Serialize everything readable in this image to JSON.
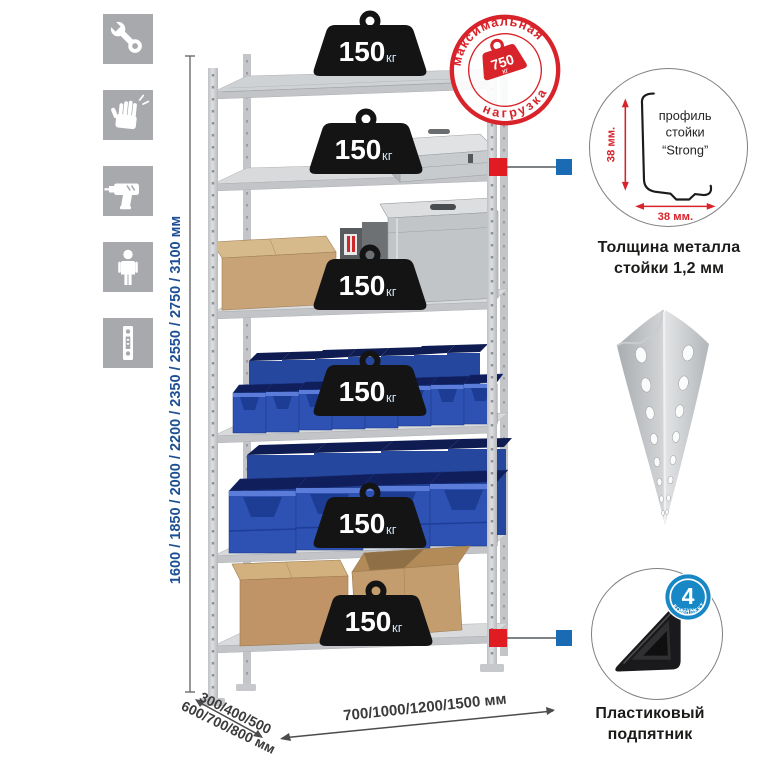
{
  "sidebar_icons": [
    {
      "name": "wrench"
    },
    {
      "name": "gloves"
    },
    {
      "name": "drill"
    },
    {
      "name": "person"
    },
    {
      "name": "rack-post"
    }
  ],
  "dimensions": {
    "height_label": "1600 / 1850 / 2000 / 2200 / 2350 / 2550 / 2750 / 3100 мм",
    "depth_line1": "300/400/500",
    "depth_line2": "600/700/800 мм",
    "width_label": "700/1000/1200/1500 мм"
  },
  "max_load_stamp": {
    "arc_top": "максимальная",
    "arc_bottom": "нагрузка",
    "value": "750",
    "unit": "кг"
  },
  "shelf_loads": [
    {
      "value": "150",
      "unit": "кг"
    },
    {
      "value": "150",
      "unit": "кг"
    },
    {
      "value": "150",
      "unit": "кг"
    },
    {
      "value": "150",
      "unit": "кг"
    },
    {
      "value": "150",
      "unit": "кг"
    },
    {
      "value": "150",
      "unit": "кг"
    }
  ],
  "profile_detail": {
    "label_line1": "профиль",
    "label_line2": "стойки",
    "label_line3": "“Strong”",
    "dim_vertical": "38 мм.",
    "dim_horizontal": "38 мм.",
    "caption_line1": "Толщина металла",
    "caption_line2": "стойки 1,2 мм"
  },
  "kit_badge": {
    "value": "4",
    "small_label": "штуки",
    "arc_label": "В КОМПЛЕКТЕ"
  },
  "foot_detail": {
    "caption_line1": "Пластиковый",
    "caption_line2": "подпятник"
  },
  "colors": {
    "accent_red": "#d8232a",
    "callout_blue": "#1b6bb4",
    "kit_badge_blue": "#1787c6",
    "dimension_blue": "#1c4f93",
    "bin_blue": "#2d52b4",
    "icon_gray": "#a7a9ac"
  }
}
